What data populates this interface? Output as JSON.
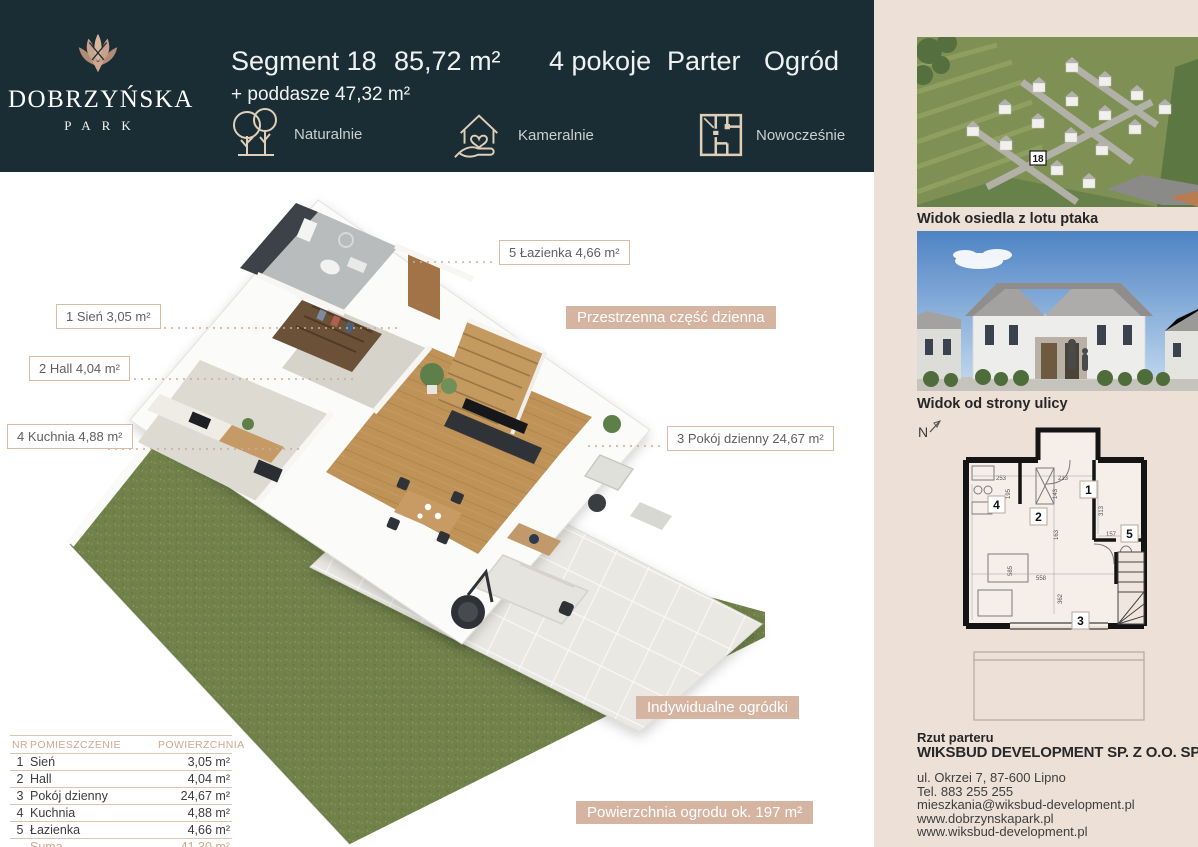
{
  "colors": {
    "header_bg": "#1b2d34",
    "accent_tan": "#d5b4a1",
    "sidebar_bg": "#ece0d7",
    "icon_gold": "#dfcfb9",
    "garden_green": "#71814a"
  },
  "header": {
    "logo": {
      "title": "DOBRZYŃSKA",
      "subtitle": "PARK"
    },
    "segment_title": "Segment 18",
    "area": "85,72 m²",
    "attic": "+ poddasze 47,32 m²",
    "rooms": "4 pokoje",
    "floor": "Parter",
    "garden": "Ogród",
    "features": [
      {
        "icon": "trees-icon",
        "label": "Naturalnie"
      },
      {
        "icon": "house-heart-icon",
        "label": "Kameralnie"
      },
      {
        "icon": "floorplan-icon",
        "label": "Nowocześnie"
      }
    ]
  },
  "plan_labels": {
    "lazienka": "5 Łazienka 4,66 m²",
    "sien": "1 Sień 3,05 m²",
    "hall": "2 Hall 4,04 m²",
    "kuchnia": "4 Kuchnia 4,88 m²",
    "pokoj": "3 Pokój dzienny 24,67 m²",
    "przestrzenna": "Przestrzenna część dzienna",
    "ogrodki": "Indywidualne ogródki",
    "powierzchnia_ogrodu": "Powierzchnia ogrodu ok. 197 m²"
  },
  "rooms_table": {
    "headers": {
      "nr": "NR",
      "name": "POMIESZCZENIE",
      "area": "POWIERZCHNIA"
    },
    "rows": [
      {
        "nr": "1",
        "name": "Sień",
        "area": "3,05 m²"
      },
      {
        "nr": "2",
        "name": "Hall",
        "area": "4,04 m²"
      },
      {
        "nr": "3",
        "name": "Pokój dzienny",
        "area": "24,67 m²"
      },
      {
        "nr": "4",
        "name": "Kuchnia",
        "area": "4,88 m²"
      },
      {
        "nr": "5",
        "name": "Łazienka",
        "area": "4,66 m²"
      }
    ],
    "sum_label": "Suma",
    "sum_value": "41,30 m²"
  },
  "sidebar": {
    "photo1_caption": "Widok osiedla z lotu ptaka",
    "photo2_caption": "Widok od strony ulicy",
    "map_marker": "18",
    "compass": "N",
    "schematic": {
      "room_numbers": [
        "1",
        "2",
        "3",
        "4",
        "5"
      ],
      "dimensions": [
        "253",
        "195",
        "213",
        "143",
        "163",
        "313",
        "157",
        "558",
        "585",
        "362"
      ]
    },
    "plan_caption": "Rzut parteru",
    "company": "WIKSBUD DEVELOPMENT SP. Z O.O. SP. K.",
    "contact": {
      "address": "ul. Okrzei 7, 87-600 Lipno",
      "phone": "Tel. 883 255 255",
      "email": "mieszkania@wiksbud-development.pl",
      "website1": "www.dobrzynskapark.pl",
      "website2": "www.wiksbud-development.pl"
    }
  }
}
